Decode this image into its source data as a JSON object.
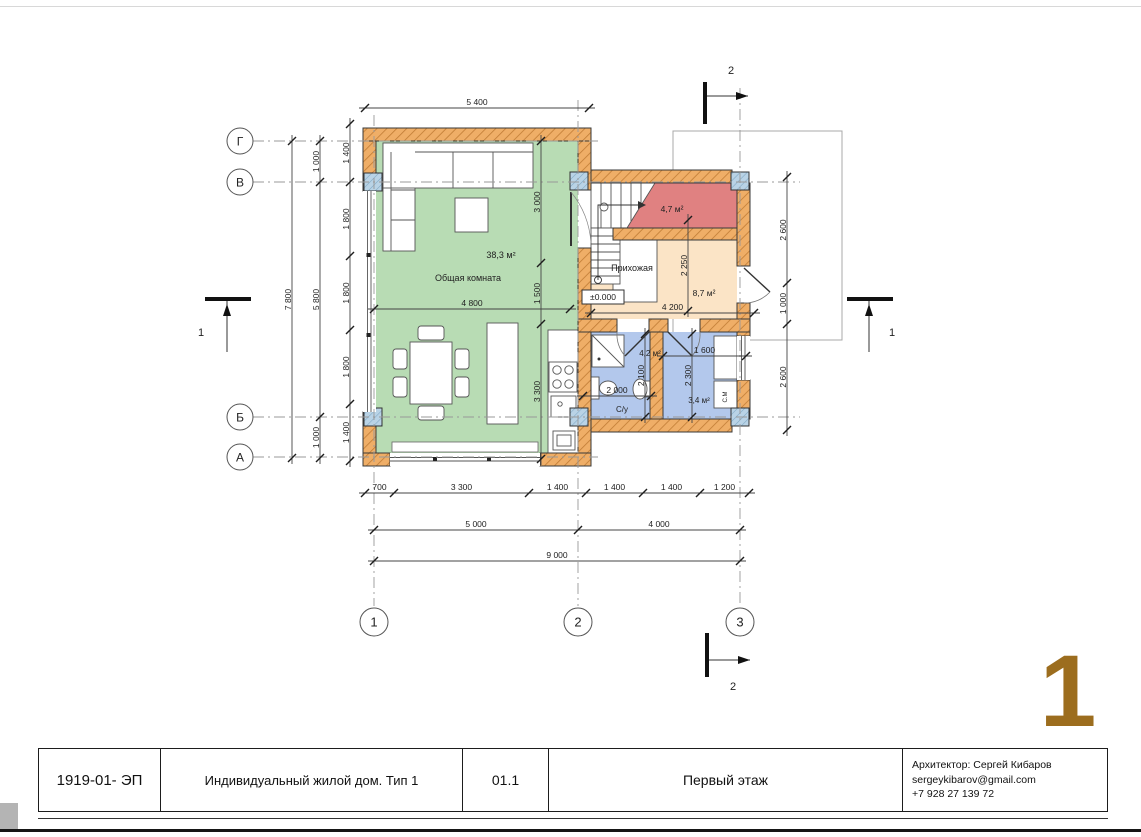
{
  "colors": {
    "wall_fill": "#efae67",
    "wall_hatch_line": "#c07c35",
    "column_fill": "#b9d3e6",
    "living_room_fill": "#b8dcb4",
    "hallway_fill": "#fbe4c6",
    "stair_room_fill": "#e08181",
    "bathroom_fill": "#b3c8ec",
    "big_number_color": "#9c6d1e"
  },
  "sheet": {
    "big_number": "1",
    "title_block": {
      "doc_code": "1919-01- ЭП",
      "project": "Индивидуальный жилой дом. Тип 1",
      "sheet_code": "01.1",
      "sheet_title": "Первый этаж",
      "architect_lines": [
        "Архитектор: Сергей Кибаров",
        "sergeykibarov@gmail.com",
        "+7 928 27 139 72"
      ]
    }
  },
  "plan": {
    "rooms": [
      {
        "name": "Общая комната",
        "area": "38,3 м²"
      },
      {
        "name": "Прихожая",
        "area": "8,7 м²"
      },
      {
        "name": "",
        "area": "4,7 м²"
      },
      {
        "name": "С/у",
        "area": "4,2 м²"
      },
      {
        "name": "",
        "area": "3,4 м²"
      }
    ],
    "level_mark": "±0.000",
    "appliance_label": "С.М"
  },
  "drawing": {
    "axes": [
      {
        "t": "Г",
        "cx": 240,
        "cy": 141,
        "r": 13,
        "fs": 12
      },
      {
        "t": "В",
        "cx": 240,
        "cy": 182,
        "r": 13,
        "fs": 12
      },
      {
        "t": "Б",
        "cx": 240,
        "cy": 417,
        "r": 13,
        "fs": 12
      },
      {
        "t": "А",
        "cx": 240,
        "cy": 457,
        "r": 13,
        "fs": 12
      },
      {
        "t": "1",
        "cx": 374,
        "cy": 622,
        "r": 14,
        "fs": 13
      },
      {
        "t": "2",
        "cx": 578,
        "cy": 622,
        "r": 14,
        "fs": 13
      },
      {
        "t": "3",
        "cx": 740,
        "cy": 622,
        "r": 14,
        "fs": 13
      }
    ],
    "dimensions": [
      {
        "o": "h",
        "at": 108,
        "points": [
          365,
          589
        ],
        "labels": [
          "5 400"
        ]
      },
      {
        "o": "h",
        "at": 493,
        "points": [
          365,
          394,
          529,
          586,
          643,
          700,
          749
        ],
        "labels": [
          "700",
          "3 300",
          "1 400",
          "1 400",
          "1 400",
          "1 200"
        ]
      },
      {
        "o": "h",
        "at": 530,
        "points": [
          374,
          578,
          740
        ],
        "labels": [
          "5 000",
          "4 000"
        ]
      },
      {
        "o": "h",
        "at": 561,
        "points": [
          374,
          740
        ],
        "labels": [
          "9 000"
        ]
      },
      {
        "o": "h",
        "at": 309,
        "points": [
          374,
          570
        ],
        "labels": [
          "4 800"
        ]
      },
      {
        "o": "h",
        "at": 313,
        "points": [
          591,
          754
        ],
        "labels": [
          "4 200"
        ]
      },
      {
        "o": "h",
        "at": 396,
        "points": [
          583,
          651
        ],
        "labels": [
          "2 000"
        ]
      },
      {
        "o": "h",
        "at": 356,
        "points": [
          663,
          746
        ],
        "labels": [
          "1 600"
        ]
      },
      {
        "o": "v",
        "at": 350,
        "points": [
          124,
          182,
          256,
          330,
          404,
          461
        ],
        "labels": [
          "1 400",
          "1 800",
          "1 800",
          "1 800",
          "1 400"
        ]
      },
      {
        "o": "v",
        "at": 320,
        "points": [
          141,
          182,
          417,
          458
        ],
        "labels": [
          "1 000",
          "5 800",
          "1 000"
        ]
      },
      {
        "o": "v",
        "at": 292,
        "points": [
          141,
          458
        ],
        "labels": [
          "7 800"
        ]
      },
      {
        "o": "v",
        "at": 787,
        "points": [
          177,
          283,
          324,
          430
        ],
        "labels": [
          "2 600",
          "1 000",
          "2 600"
        ]
      },
      {
        "o": "v",
        "at": 541,
        "points": [
          141,
          263,
          324,
          459
        ],
        "labels": [
          "3 000",
          "1 500",
          "3 300"
        ]
      },
      {
        "o": "v",
        "at": 688,
        "points": [
          220,
          311
        ],
        "labels": [
          "2 250"
        ]
      },
      {
        "o": "v",
        "at": 645,
        "points": [
          334,
          417
        ],
        "labels": [
          "2 100"
        ]
      },
      {
        "o": "v",
        "at": 692,
        "points": [
          334,
          417
        ],
        "labels": [
          "2 300"
        ]
      }
    ],
    "labels": [
      {
        "t": "38,3 м²",
        "x": 501,
        "y": 258,
        "s": 9
      },
      {
        "t": "Общая комната",
        "x": 468,
        "y": 281,
        "s": 9
      },
      {
        "t": "Прихожая",
        "x": 632,
        "y": 271,
        "s": 9
      },
      {
        "t": "8,7 м²",
        "x": 704,
        "y": 296,
        "s": 8.5
      },
      {
        "t": "4,7 м²",
        "x": 672,
        "y": 212,
        "s": 8.5
      },
      {
        "t": "4,2 м²",
        "x": 650,
        "y": 356,
        "s": 8
      },
      {
        "t": "3,4 м²",
        "x": 699,
        "y": 403,
        "s": 8
      },
      {
        "t": "С/у",
        "x": 622,
        "y": 412,
        "s": 8
      },
      {
        "t": "С.М",
        "x": 727,
        "y": 397,
        "s": 6,
        "r": -90
      },
      {
        "t": "±0.000",
        "x": 603,
        "y": 300,
        "s": 8.5
      },
      {
        "t": "2",
        "x": 731,
        "y": 74,
        "s": 11
      },
      {
        "t": "2",
        "x": 733,
        "y": 690,
        "s": 11
      },
      {
        "t": "1",
        "x": 201,
        "y": 336,
        "s": 11
      },
      {
        "t": "1",
        "x": 892,
        "y": 336,
        "s": 11
      }
    ]
  }
}
